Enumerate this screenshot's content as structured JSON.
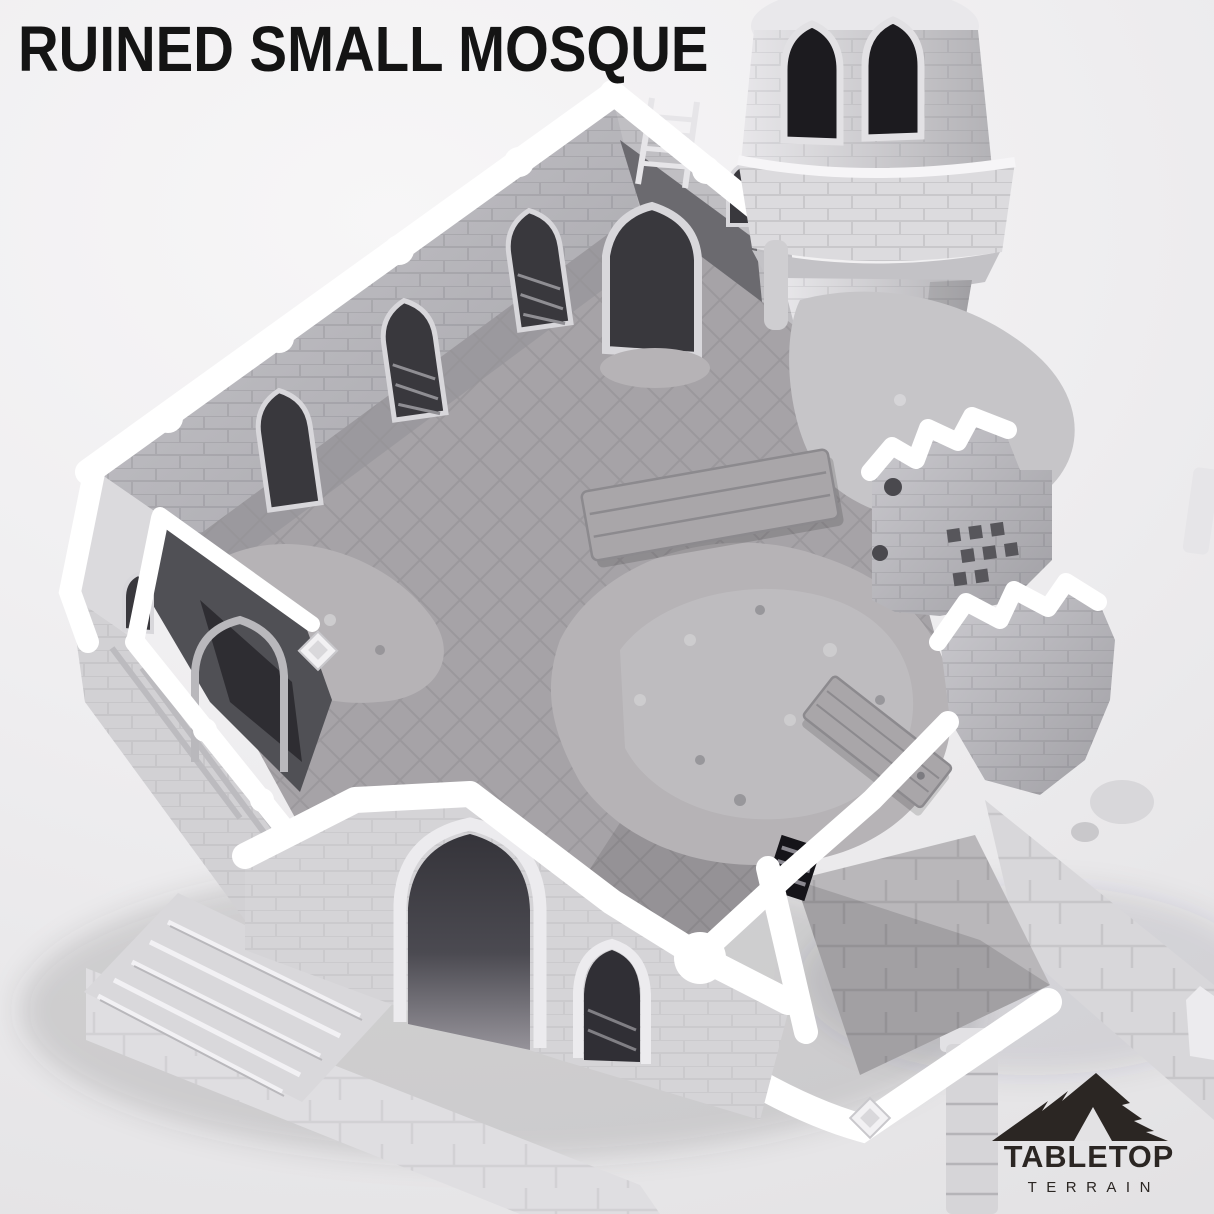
{
  "title": "RUINED SMALL MOSQUE",
  "logo": {
    "brand": "TABLETOP",
    "sub": "TERRAIN"
  },
  "scene": {
    "description": "Grayscale 3D render of a ruined small mosque terrain piece, isometric top-down view, roofless stone walls with pointed arch windows, minaret tower at upper right, rubble and fallen door planks on tiled floor, entry steps at lower left",
    "elements": [
      "minaret-tower",
      "back-wall",
      "corner-porch",
      "west-porch",
      "front-facade",
      "entry-steps",
      "interior-floor",
      "rubble-mounds",
      "fallen-planks",
      "ruined-walls-right",
      "courtyard",
      "paving-path",
      "stone-column"
    ]
  },
  "colors": {
    "bg_light": "#f7f6f7",
    "bg_edge": "#e3e2e4",
    "ink": "#141414",
    "logo_ink": "#2b2623",
    "white": "#ffffff",
    "stone_lightest": "#f1f0f2",
    "stone_light": "#dbdadd",
    "stone_mid": "#c0bfc3",
    "stone": "#aeadb1",
    "stone_dark": "#949398",
    "stone_deep": "#7a797e",
    "opening": "#39383d",
    "opening_deep": "#1c1b1f",
    "floor": "#a6a3a7",
    "rubble": "#b6b3b6"
  }
}
